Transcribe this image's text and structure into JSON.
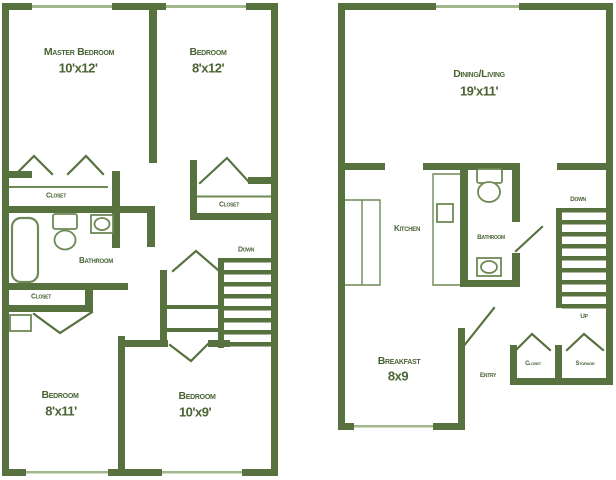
{
  "palette": {
    "wall": "#57713f",
    "line": "#6d8955",
    "win": "#a3b78c",
    "text": "#4a6434"
  },
  "upper_floor": {
    "master_bedroom": {
      "label": "Master Bedroom",
      "dims": "10'x12'"
    },
    "bedroom_2": {
      "label": "Bedroom",
      "dims": "8'x12'"
    },
    "bedroom_3": {
      "label": "Bedroom",
      "dims": "8'x11'"
    },
    "bedroom_4": {
      "label": "Bedroom",
      "dims": "10'x9'"
    },
    "bathroom_label": "Bathroom",
    "closet_label": "Closet",
    "down_label": "Down"
  },
  "main_floor": {
    "dining_living": {
      "label": "Dining/Living",
      "dims": "19'x11'"
    },
    "breakfast": {
      "label": "Breakfast",
      "dims": "8x9"
    },
    "kitchen_label": "Kitchen",
    "bathroom_label": "Bathroom",
    "entry_label": "Entry",
    "closet_label": "Closet",
    "storage_label": "Storage",
    "down_label": "Down",
    "up_label": "Up"
  }
}
